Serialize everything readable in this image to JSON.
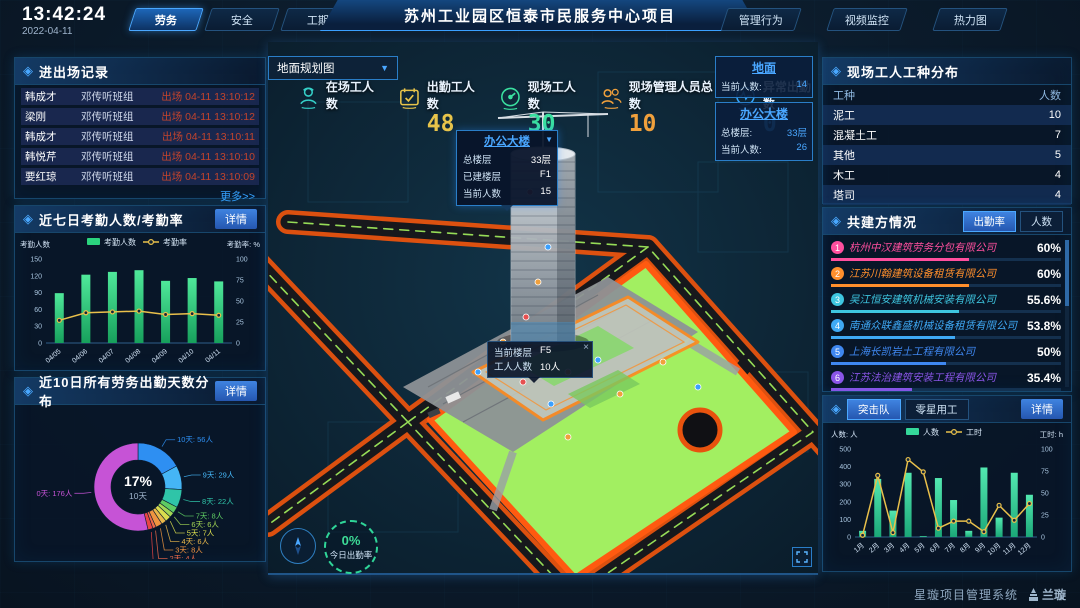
{
  "header": {
    "time": "13:42:24",
    "date": "2022-04-11",
    "left_tabs": [
      {
        "label": "劳务",
        "active": true
      },
      {
        "label": "安全",
        "active": false
      },
      {
        "label": "工期",
        "active": false
      }
    ],
    "title": "苏州工业园区恒泰市民服务中心项目",
    "right_tabs": [
      {
        "label": "管理行为"
      },
      {
        "label": "视频监控"
      },
      {
        "label": "热力图"
      }
    ]
  },
  "entry_exit": {
    "title": "进出场记录",
    "more_label": "更多>>",
    "rows": [
      {
        "name": "韩成才",
        "team": "邓传听班组",
        "event": "出场 04-11 13:10:12"
      },
      {
        "name": "梁刚",
        "team": "邓传听班组",
        "event": "出场 04-11 13:10:12"
      },
      {
        "name": "韩成才",
        "team": "邓传听班组",
        "event": "出场 04-11 13:10:11"
      },
      {
        "name": "韩悦芹",
        "team": "邓传听班组",
        "event": "出场 04-11 13:10:10"
      },
      {
        "name": "要红琼",
        "team": "邓传听班组",
        "event": "出场 04-11 13:10:09"
      }
    ]
  },
  "attendance7": {
    "title": "近七日考勤人数/考勤率",
    "detail_label": "详情"
  },
  "distribution10": {
    "title": "近10日所有劳务出勤天数分布",
    "detail_label": "详情"
  },
  "worker_types": {
    "title": "现场工人工种分布",
    "col_type": "工种",
    "col_count": "人数",
    "rows": [
      {
        "type": "泥工",
        "count": "10"
      },
      {
        "type": "混凝土工",
        "count": "7"
      },
      {
        "type": "其他",
        "count": "5"
      },
      {
        "type": "木工",
        "count": "4"
      },
      {
        "type": "塔司",
        "count": "4"
      }
    ]
  },
  "partners": {
    "title": "共建方情况",
    "tabs": [
      {
        "label": "出勤率",
        "active": true
      },
      {
        "label": "人数",
        "active": false
      }
    ],
    "companies": [
      {
        "rank": "1",
        "name": "杭州中汉建筑劳务分包有限公司",
        "value": "60%",
        "pct": 60,
        "color": "#ff4f9e"
      },
      {
        "rank": "2",
        "name": "江苏川翰建筑设备租赁有限公司",
        "value": "60%",
        "pct": 60,
        "color": "#ff8f2c"
      },
      {
        "rank": "3",
        "name": "吴江恒安建筑机械安装有限公司",
        "value": "55.6%",
        "pct": 55.6,
        "color": "#3ec6e0"
      },
      {
        "rank": "4",
        "name": "南通众联鑫盛机械设备租赁有限公司",
        "value": "53.8%",
        "pct": 53.8,
        "color": "#3fa9f5"
      },
      {
        "rank": "5",
        "name": "上海长凯岩土工程有限公司",
        "value": "50%",
        "pct": 50,
        "color": "#3f87f0"
      },
      {
        "rank": "6",
        "name": "江苏法治建筑安装工程有限公司",
        "value": "35.4%",
        "pct": 35.4,
        "color": "#8a55e8"
      }
    ]
  },
  "teams": {
    "tabs": [
      {
        "label": "突击队",
        "active": true
      },
      {
        "label": "零星用工",
        "active": false
      }
    ],
    "detail_label": "详情"
  },
  "map": {
    "view_select": "地面规划图",
    "stats": [
      {
        "icon": "worker-icon",
        "label": "在场工人数",
        "value": "",
        "color": "#35d0c8"
      },
      {
        "icon": "calendar-icon",
        "label": "出勤工人数",
        "value": "48",
        "color": "#e8c44a"
      },
      {
        "icon": "gauge-icon",
        "label": "现场工人数",
        "value": "30",
        "color": "#3ae0a0"
      },
      {
        "icon": "people-icon",
        "label": "现场管理人员总数",
        "value": "10",
        "color": "#f0a03c"
      },
      {
        "icon": "pulse-icon",
        "label": "异常出勤数",
        "value": "0",
        "color": "#35a6ff"
      }
    ],
    "building_popup": {
      "title": "办公大楼",
      "rows": [
        {
          "label": "总楼层",
          "value": "33层"
        },
        {
          "label": "已建楼层",
          "value": "F1"
        },
        {
          "label": "当前人数",
          "value": "15"
        }
      ]
    },
    "floor_tooltip": {
      "close": "×",
      "rows": [
        {
          "label": "当前楼层",
          "value": "F5"
        },
        {
          "label": "工人人数",
          "value": "10人"
        }
      ]
    },
    "overlays": [
      {
        "title": "地面",
        "rows": [
          {
            "label": "当前人数:",
            "value": "14"
          }
        ]
      },
      {
        "title": "办公大楼",
        "rows": [
          {
            "label": "总楼层:",
            "value": "33层"
          },
          {
            "label": "当前人数:",
            "value": "26"
          }
        ]
      }
    ],
    "attendance_ring": {
      "pct": "0%",
      "label": "今日出勤率"
    }
  },
  "footer": {
    "system_name": "星璇项目管理系统",
    "logo_text": "兰璇"
  },
  "chart_data": [
    {
      "id": "attendance7",
      "type": "bar+line",
      "title": "近七日考勤人数/考勤率",
      "categories": [
        "04/05",
        "04/06",
        "04/07",
        "04/08",
        "04/09",
        "04/10",
        "04/11"
      ],
      "series": [
        {
          "name": "考勤人数",
          "type": "bar",
          "axis": "left",
          "color": "#2bd47e",
          "values": [
            89,
            122,
            127,
            130,
            111,
            116,
            110
          ]
        },
        {
          "name": "考勤率",
          "type": "line",
          "axis": "right",
          "color": "#e9c04b",
          "values": [
            27,
            36,
            37,
            38,
            34,
            35,
            33
          ]
        }
      ],
      "left_axis": {
        "title": "考勤人数",
        "min": 0,
        "max": 150,
        "step": 30
      },
      "right_axis": {
        "title": "考勤率: %",
        "min": 0,
        "max": 100,
        "step": 25
      },
      "legend_position": "top"
    },
    {
      "id": "distribution10",
      "type": "donut",
      "title": "近10日所有劳务出勤天数分布",
      "center": {
        "pct": "17%",
        "label": "10天"
      },
      "label_suffix": "人",
      "slices": [
        {
          "label": "10天",
          "count": 56,
          "color": "#2e8ff2"
        },
        {
          "label": "9天",
          "count": 29,
          "color": "#45b5f5"
        },
        {
          "label": "8天",
          "count": 22,
          "color": "#2fc4a8"
        },
        {
          "label": "7天",
          "count": 8,
          "color": "#5ecb63"
        },
        {
          "label": "6天",
          "count": 6,
          "color": "#a3d654"
        },
        {
          "label": "5天",
          "count": 7,
          "color": "#d9dc4e"
        },
        {
          "label": "4天",
          "count": 6,
          "color": "#e9b74a"
        },
        {
          "label": "3天",
          "count": 8,
          "color": "#ef9440"
        },
        {
          "label": "2天",
          "count": 4,
          "color": "#ee6a4a"
        },
        {
          "label": "1天",
          "count": 6,
          "color": "#e84545"
        },
        {
          "label": "0天",
          "count": 176,
          "color": "#c653d6"
        }
      ]
    },
    {
      "id": "teams",
      "type": "bar+line",
      "title": "突击队",
      "categories": [
        "1月",
        "2月",
        "3月",
        "4月",
        "5月",
        "6月",
        "7月",
        "8月",
        "9月",
        "10月",
        "11月",
        "12月"
      ],
      "series": [
        {
          "name": "人数",
          "type": "bar",
          "axis": "left",
          "color": "#35d89a",
          "values": [
            35,
            330,
            150,
            365,
            5,
            335,
            210,
            35,
            395,
            110,
            365,
            240
          ]
        },
        {
          "name": "工时",
          "type": "line",
          "axis": "right",
          "color": "#e9c04b",
          "values": [
            2,
            70,
            5,
            88,
            74,
            10,
            18,
            18,
            6,
            36,
            19,
            38
          ]
        }
      ],
      "left_axis": {
        "title": "人数: 人",
        "min": 0,
        "max": 500,
        "step": 100
      },
      "right_axis": {
        "title": "工时: h",
        "min": 0,
        "max": 100,
        "step": 25
      },
      "legend_position": "top"
    }
  ]
}
